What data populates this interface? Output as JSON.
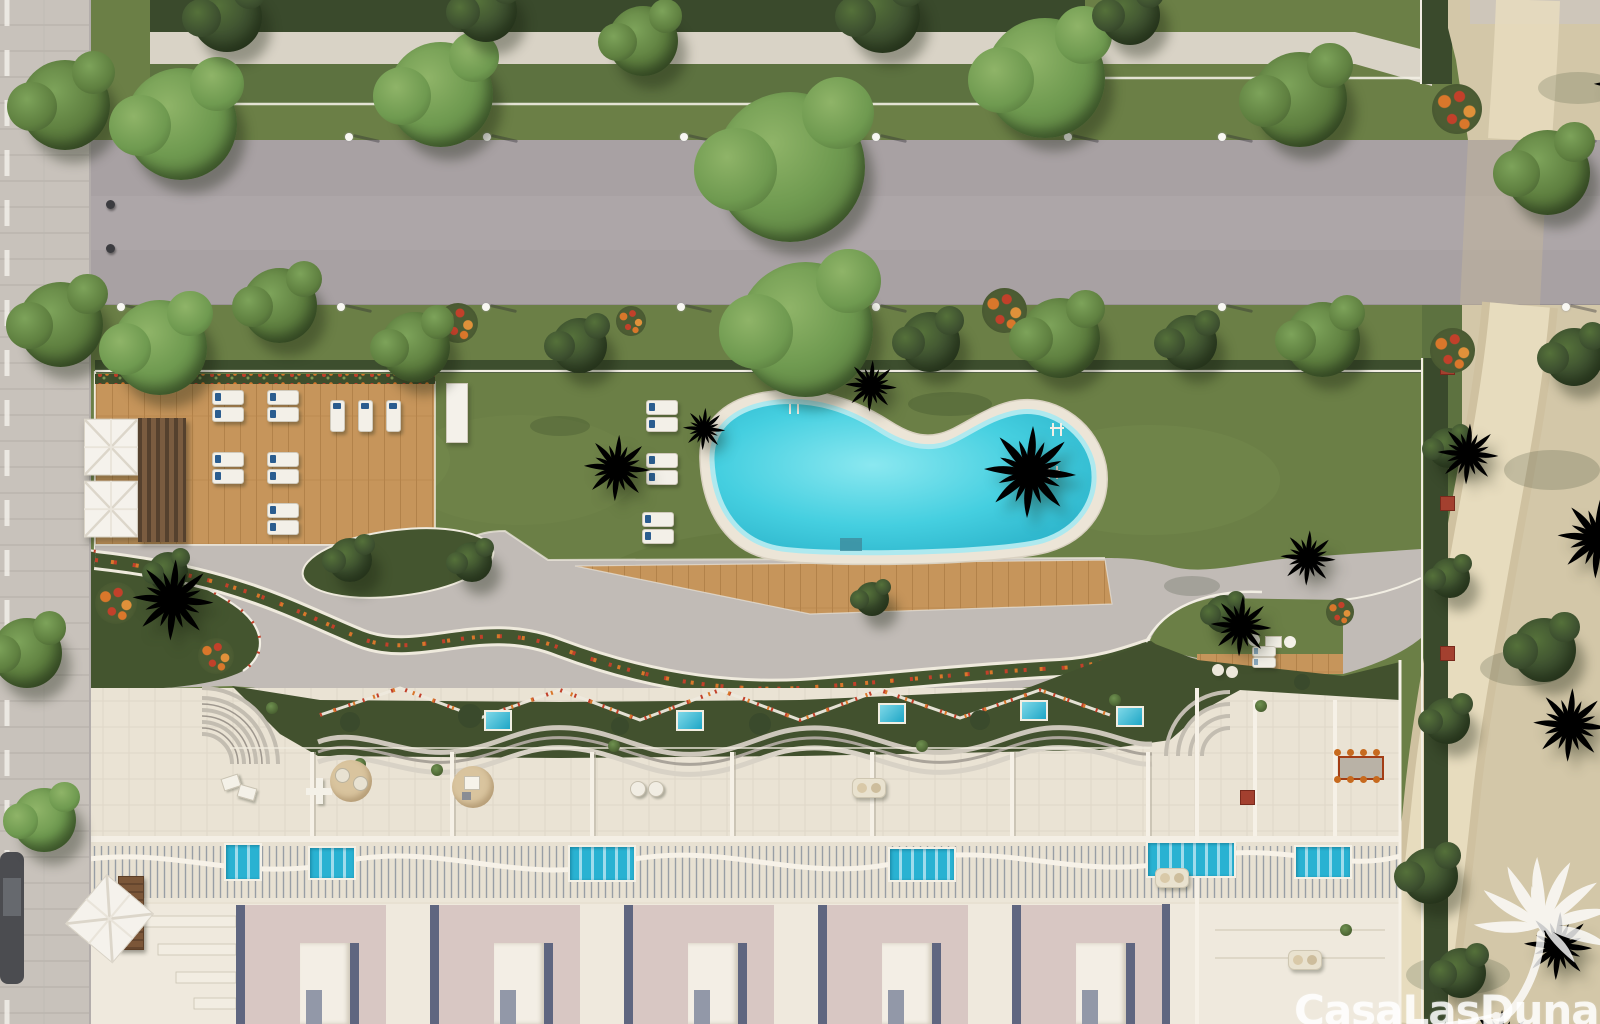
{
  "watermark": {
    "text": "CasaLasDunas",
    "logo_icon": "palm-tree-logo"
  },
  "palette": {
    "lawn": "#6b7f46",
    "lawn_dark": "#556b39",
    "hedge": "#3a4a2c",
    "roof_garden": "#42512e",
    "bed_green": "#44552f",
    "road": "#a8a1a3",
    "sidewalk": "#c8c2bb",
    "gravel": "#d9d3c6",
    "path_gray": "#c1bbb6",
    "sand": "#d3c7a8",
    "sand_path": "#e7dcbe",
    "wood": "#c6955b",
    "wood_dark": "#aa7a42",
    "cream": "#eae3d4",
    "rosy": "#d8c7c3",
    "slate": "#5f6680",
    "pool_deep": "#22a9c2",
    "pool_mid": "#45cfe0",
    "pool_light": "#8ae8f0",
    "balcony_pool": "#2ab4d4",
    "palm_dark": "#4a6531",
    "palm_light": "#66843f",
    "flower_orange": "#d9772b",
    "flower_red": "#c2402a",
    "planter_red": "#a3402f",
    "watermark_white": "rgba(255,255,255,0.82)"
  },
  "scene": {
    "objects": [
      {
        "t": "wallunit",
        "x": 236,
        "y": 905
      },
      {
        "t": "wallunit",
        "x": 430,
        "y": 905
      },
      {
        "t": "wallunit",
        "x": 624,
        "y": 905
      },
      {
        "t": "wallunit",
        "x": 818,
        "y": 905
      },
      {
        "t": "wallunit",
        "x": 1012,
        "y": 905
      },
      {
        "t": "lap",
        "x": 224,
        "y": 843,
        "w": 34,
        "h": 34
      },
      {
        "t": "lap",
        "x": 308,
        "y": 846,
        "w": 44,
        "h": 30
      },
      {
        "t": "lap",
        "x": 568,
        "y": 845,
        "w": 64,
        "h": 33
      },
      {
        "t": "lap",
        "x": 888,
        "y": 847,
        "w": 64,
        "h": 31
      },
      {
        "t": "lap",
        "x": 1146,
        "y": 841,
        "w": 86,
        "h": 33
      },
      {
        "t": "lap",
        "x": 1294,
        "y": 845,
        "w": 54,
        "h": 30
      },
      {
        "t": "plunge",
        "x": 484,
        "y": 710
      },
      {
        "t": "plunge",
        "x": 676,
        "y": 710
      },
      {
        "t": "plunge",
        "x": 878,
        "y": 703
      },
      {
        "t": "plunge",
        "x": 1020,
        "y": 700
      },
      {
        "t": "plunge",
        "x": 1116,
        "y": 706
      },
      {
        "t": "planter",
        "x": 1440,
        "y": 360
      },
      {
        "t": "planter",
        "x": 1440,
        "y": 496
      },
      {
        "t": "planter",
        "x": 1440,
        "y": 646
      },
      {
        "t": "planter",
        "x": 1240,
        "y": 790
      },
      {
        "t": "flowers",
        "x": 438,
        "y": 303,
        "s": 40
      },
      {
        "t": "flowers",
        "x": 982,
        "y": 288,
        "s": 45
      },
      {
        "t": "flowers",
        "x": 1432,
        "y": 84,
        "s": 50
      },
      {
        "t": "flowers",
        "x": 1430,
        "y": 328,
        "s": 45
      },
      {
        "t": "flowers",
        "x": 616,
        "y": 306,
        "s": 30
      },
      {
        "t": "flowers",
        "x": 95,
        "y": 582,
        "s": 42
      },
      {
        "t": "flowers",
        "x": 198,
        "y": 638,
        "s": 36
      },
      {
        "t": "flowers",
        "x": 1326,
        "y": 598,
        "s": 28
      },
      {
        "t": "tuft",
        "x": 266,
        "y": 702
      },
      {
        "t": "tuft",
        "x": 354,
        "y": 758
      },
      {
        "t": "tuft",
        "x": 431,
        "y": 764
      },
      {
        "t": "tuft",
        "x": 608,
        "y": 740
      },
      {
        "t": "tuft",
        "x": 916,
        "y": 740
      },
      {
        "t": "tuft",
        "x": 1109,
        "y": 694
      },
      {
        "t": "tuft",
        "x": 1255,
        "y": 700
      },
      {
        "t": "tuft",
        "x": 1340,
        "y": 924
      },
      {
        "t": "chairs2",
        "x": 222,
        "y": 774
      },
      {
        "t": "tablecross",
        "x": 306,
        "y": 778
      },
      {
        "t": "rug",
        "x": 452,
        "y": 766
      },
      {
        "t": "chairpair",
        "x": 630,
        "y": 781
      },
      {
        "t": "sofa",
        "x": 852,
        "y": 778
      },
      {
        "t": "sofa",
        "x": 1155,
        "y": 868
      },
      {
        "t": "dining",
        "x": 1330,
        "y": 750
      },
      {
        "t": "nook",
        "x": 1248,
        "y": 628
      },
      {
        "t": "ottomans",
        "x": 1212,
        "y": 664
      },
      {
        "t": "sofa",
        "x": 1288,
        "y": 950
      },
      {
        "t": "browntable",
        "x": 118,
        "y": 876,
        "w": 24,
        "h": 72
      },
      {
        "t": "rug2",
        "x": 330,
        "y": 760
      },
      {
        "t": "lng",
        "x": 212,
        "y": 390
      },
      {
        "t": "lng",
        "x": 212,
        "y": 407
      },
      {
        "t": "lng",
        "x": 267,
        "y": 390
      },
      {
        "t": "lng",
        "x": 267,
        "y": 407
      },
      {
        "t": "lng",
        "x": 212,
        "y": 452
      },
      {
        "t": "lng",
        "x": 212,
        "y": 469
      },
      {
        "t": "lng",
        "x": 267,
        "y": 452
      },
      {
        "t": "lng",
        "x": 267,
        "y": 469
      },
      {
        "t": "lng",
        "x": 267,
        "y": 503
      },
      {
        "t": "lng",
        "x": 267,
        "y": 520
      },
      {
        "t": "lngv",
        "x": 330,
        "y": 400
      },
      {
        "t": "lngv",
        "x": 358,
        "y": 400
      },
      {
        "t": "lngv",
        "x": 386,
        "y": 400
      },
      {
        "t": "lng",
        "x": 646,
        "y": 400
      },
      {
        "t": "lng",
        "x": 646,
        "y": 417
      },
      {
        "t": "lng",
        "x": 646,
        "y": 453
      },
      {
        "t": "lng",
        "x": 646,
        "y": 470
      },
      {
        "t": "lng",
        "x": 642,
        "y": 512
      },
      {
        "t": "lng",
        "x": 642,
        "y": 529
      },
      {
        "t": "lngs",
        "x": 1252,
        "y": 646
      },
      {
        "t": "lngs",
        "x": 1252,
        "y": 657
      },
      {
        "t": "para",
        "x": 84,
        "y": 418,
        "s": 54
      },
      {
        "t": "para",
        "x": 84,
        "y": 480,
        "s": 54
      },
      {
        "t": "para45",
        "x": 78,
        "y": 886,
        "s": 62
      },
      {
        "t": "pergola",
        "x": 138,
        "y": 418,
        "w": 48,
        "h": 124
      },
      {
        "t": "cab",
        "x": 446,
        "y": 383,
        "w": 20,
        "h": 58
      },
      {
        "t": "lamp",
        "x": 150,
        "y": 126
      },
      {
        "t": "lamp",
        "x": 345,
        "y": 126
      },
      {
        "t": "lamp",
        "x": 483,
        "y": 126
      },
      {
        "t": "lamp",
        "x": 680,
        "y": 126
      },
      {
        "t": "lamp",
        "x": 872,
        "y": 126
      },
      {
        "t": "lamp",
        "x": 1064,
        "y": 126
      },
      {
        "t": "lamp",
        "x": 1218,
        "y": 126
      },
      {
        "t": "lamp",
        "x": 1562,
        "y": 126
      },
      {
        "t": "lamp",
        "x": 117,
        "y": 296
      },
      {
        "t": "lamp",
        "x": 337,
        "y": 296
      },
      {
        "t": "lamp",
        "x": 482,
        "y": 296
      },
      {
        "t": "lamp",
        "x": 677,
        "y": 296
      },
      {
        "t": "lamp",
        "x": 872,
        "y": 296
      },
      {
        "t": "lamp",
        "x": 1067,
        "y": 296
      },
      {
        "t": "lamp",
        "x": 1218,
        "y": 296
      },
      {
        "t": "lamp",
        "x": 1562,
        "y": 296
      },
      {
        "t": "bol",
        "x": 106,
        "y": 200
      },
      {
        "t": "bol",
        "x": 106,
        "y": 244
      },
      {
        "t": "tree",
        "x": 20,
        "y": 60,
        "s": 90,
        "tone": 2
      },
      {
        "t": "tree",
        "x": 125,
        "y": 68,
        "s": 112,
        "tone": 1
      },
      {
        "t": "tree",
        "x": 388,
        "y": 42,
        "s": 105,
        "tone": 1
      },
      {
        "t": "tree",
        "x": 608,
        "y": 6,
        "s": 70,
        "tone": 2
      },
      {
        "t": "tree",
        "x": 715,
        "y": 92,
        "s": 150,
        "tone": 1
      },
      {
        "t": "tree",
        "x": 985,
        "y": 18,
        "s": 120,
        "tone": 1
      },
      {
        "t": "tree",
        "x": 1252,
        "y": 52,
        "s": 95,
        "tone": 2
      },
      {
        "t": "tree",
        "x": 192,
        "y": -18,
        "s": 70,
        "tone": 3
      },
      {
        "t": "tree",
        "x": 455,
        "y": -20,
        "s": 62,
        "tone": 3
      },
      {
        "t": "tree",
        "x": 845,
        "y": -22,
        "s": 75,
        "tone": 3
      },
      {
        "t": "tree",
        "x": 1100,
        "y": -15,
        "s": 60,
        "tone": 3
      },
      {
        "t": "tree",
        "x": 18,
        "y": 282,
        "s": 85,
        "tone": 2
      },
      {
        "t": "tree",
        "x": 112,
        "y": 300,
        "s": 95,
        "tone": 1
      },
      {
        "t": "tree",
        "x": 242,
        "y": 268,
        "s": 75,
        "tone": 2
      },
      {
        "t": "tree",
        "x": 380,
        "y": 312,
        "s": 70,
        "tone": 2
      },
      {
        "t": "tree",
        "x": 552,
        "y": 318,
        "s": 55,
        "tone": 3
      },
      {
        "t": "tree",
        "x": 738,
        "y": 262,
        "s": 135,
        "tone": 1
      },
      {
        "t": "tree",
        "x": 900,
        "y": 312,
        "s": 60,
        "tone": 3
      },
      {
        "t": "tree",
        "x": 1020,
        "y": 298,
        "s": 80,
        "tone": 2
      },
      {
        "t": "tree",
        "x": 1162,
        "y": 315,
        "s": 55,
        "tone": 3
      },
      {
        "t": "tree",
        "x": 1285,
        "y": 302,
        "s": 75,
        "tone": 2
      },
      {
        "t": "tree",
        "x": -8,
        "y": 618,
        "s": 70,
        "tone": 2
      },
      {
        "t": "tree",
        "x": 12,
        "y": 788,
        "s": 64,
        "tone": 1
      },
      {
        "t": "tree",
        "x": 1505,
        "y": 130,
        "s": 85,
        "tone": 2
      },
      {
        "t": "tree",
        "x": 1545,
        "y": 328,
        "s": 58,
        "tone": 3
      },
      {
        "t": "tree",
        "x": 1512,
        "y": 618,
        "s": 64,
        "tone": 3
      },
      {
        "t": "tree",
        "x": 328,
        "y": 538,
        "s": 44,
        "tone": 3
      },
      {
        "t": "tree",
        "x": 452,
        "y": 542,
        "s": 40,
        "tone": 3
      },
      {
        "t": "tree",
        "x": 148,
        "y": 552,
        "s": 40,
        "tone": 3
      },
      {
        "t": "tree",
        "x": 855,
        "y": 582,
        "s": 34,
        "tone": 3
      },
      {
        "t": "tree",
        "x": 1205,
        "y": 595,
        "s": 38,
        "tone": 3
      },
      {
        "t": "tree",
        "x": 1428,
        "y": 428,
        "s": 40,
        "tone": 3
      },
      {
        "t": "tree",
        "x": 1430,
        "y": 558,
        "s": 40,
        "tone": 3
      },
      {
        "t": "tree",
        "x": 1424,
        "y": 698,
        "s": 46,
        "tone": 3
      },
      {
        "t": "tree",
        "x": 1402,
        "y": 848,
        "s": 56,
        "tone": 3
      },
      {
        "t": "tree",
        "x": 1436,
        "y": 948,
        "s": 50,
        "tone": 3
      },
      {
        "t": "palm",
        "x": 930,
        "y": 372,
        "s": 100
      },
      {
        "t": "palm",
        "x": 545,
        "y": 396,
        "s": 72
      },
      {
        "t": "palm",
        "x": 85,
        "y": 512,
        "s": 88
      },
      {
        "t": "palm",
        "x": 815,
        "y": 330,
        "s": 56
      },
      {
        "t": "palm",
        "x": 1175,
        "y": 560,
        "s": 66
      },
      {
        "t": "palm",
        "x": 1248,
        "y": 498,
        "s": 60
      },
      {
        "t": "palm",
        "x": 1402,
        "y": 388,
        "s": 66
      },
      {
        "t": "palm",
        "x": 658,
        "y": 383,
        "s": 46
      },
      {
        "t": "palm",
        "x": 1510,
        "y": 450,
        "s": 88,
        "dark": 1
      },
      {
        "t": "palm",
        "x": 1490,
        "y": 645,
        "s": 80,
        "dark": 1
      },
      {
        "t": "palm",
        "x": 1556,
        "y": 16,
        "s": 70,
        "dark": 1
      },
      {
        "t": "palm",
        "x": 1430,
        "y": 972,
        "s": 70,
        "dark": 1
      },
      {
        "t": "palm",
        "x": 1484,
        "y": 872,
        "s": 74,
        "dark": 1
      }
    ]
  }
}
